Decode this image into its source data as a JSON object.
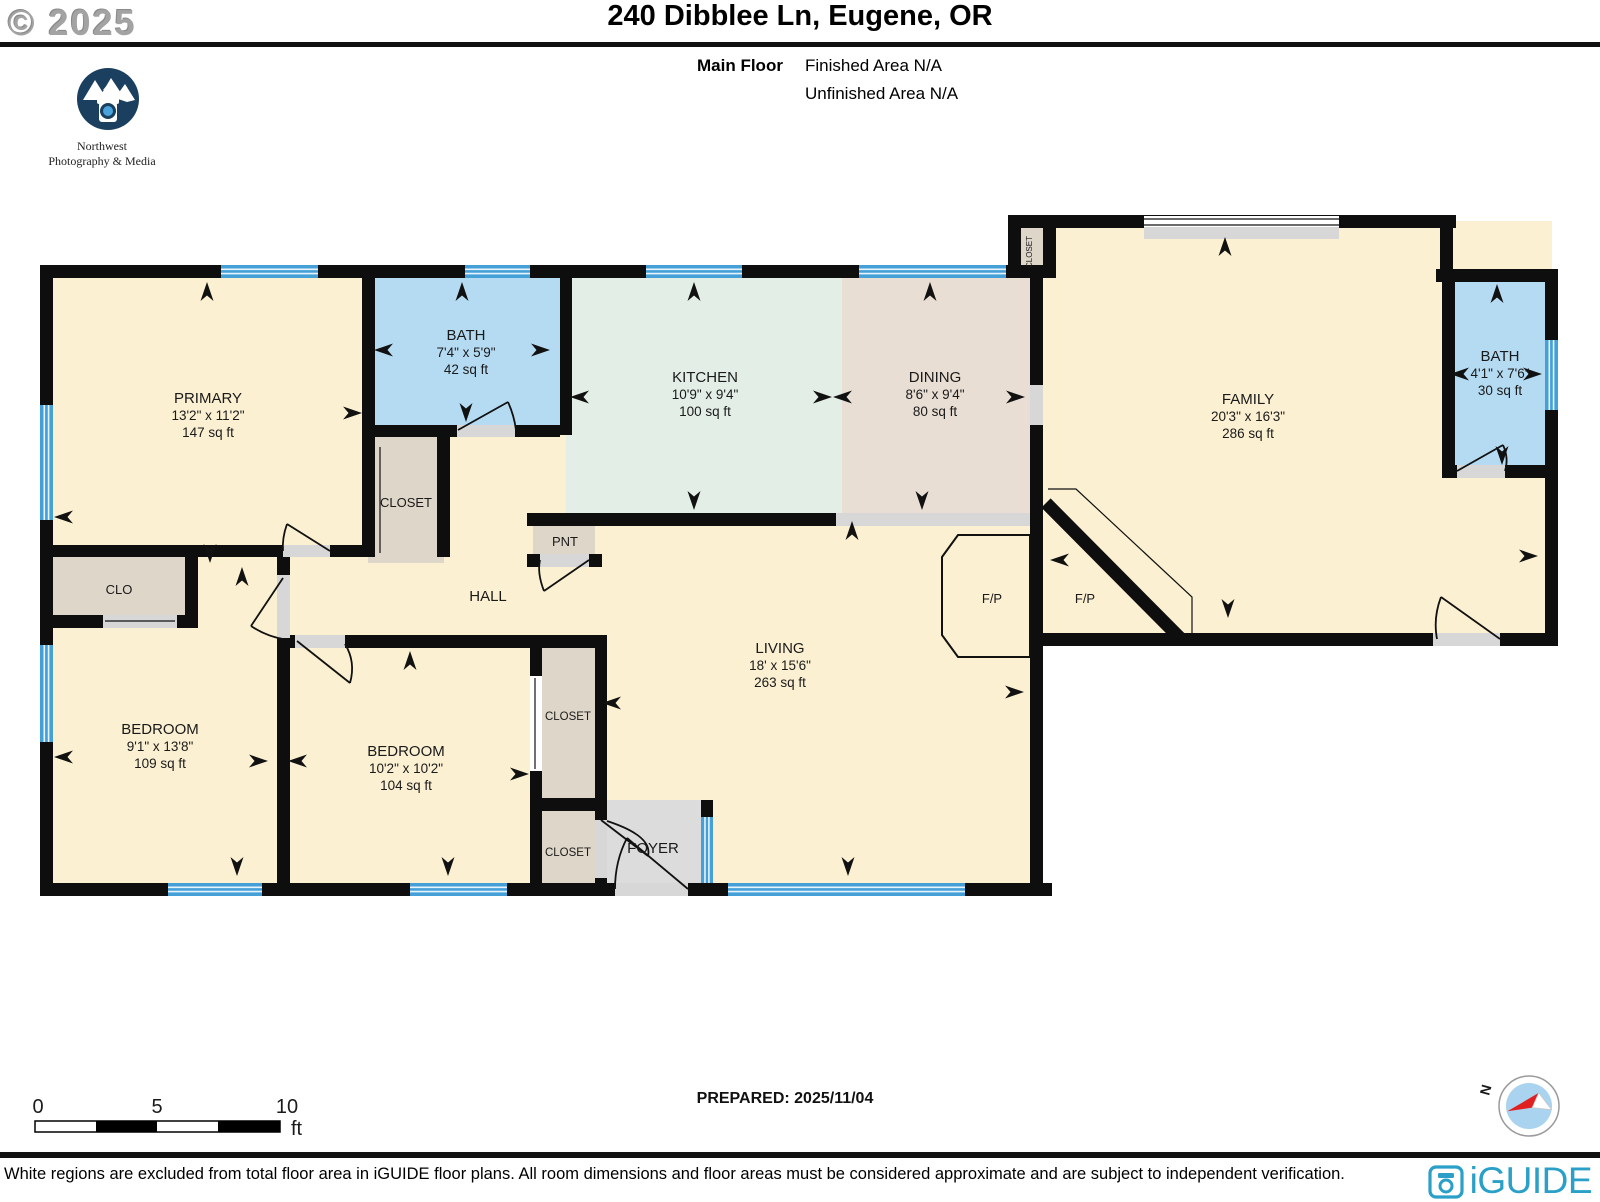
{
  "header": {
    "copyright": "© 2025",
    "title": "240 Dibblee Ln, Eugene, OR",
    "floor_label": "Main Floor",
    "finished_area": "Finished Area N/A",
    "unfinished_area": "Unfinished Area N/A",
    "logo_line1": "Northwest",
    "logo_line2": "Photography & Media"
  },
  "rooms": {
    "primary": {
      "name": "PRIMARY",
      "dims": "13'2\" x 11'2\"",
      "area": "147 sq ft"
    },
    "bath1": {
      "name": "BATH",
      "dims": "7'4\" x 5'9\"",
      "area": "42 sq ft"
    },
    "kitchen": {
      "name": "KITCHEN",
      "dims": "10'9\" x 9'4\"",
      "area": "100 sq ft"
    },
    "dining": {
      "name": "DINING",
      "dims": "8'6\" x 9'4\"",
      "area": "80 sq ft"
    },
    "family": {
      "name": "FAMILY",
      "dims": "20'3\" x 16'3\"",
      "area": "286 sq ft"
    },
    "bath2": {
      "name": "BATH",
      "dims": "4'1\" x 7'6\"",
      "area": "30 sq ft"
    },
    "living": {
      "name": "LIVING",
      "dims": "18' x 15'6\"",
      "area": "263 sq ft"
    },
    "bedroom1": {
      "name": "BEDROOM",
      "dims": "9'1\" x 13'8\"",
      "area": "109 sq ft"
    },
    "bedroom2": {
      "name": "BEDROOM",
      "dims": "10'2\" x 10'2\"",
      "area": "104 sq ft"
    },
    "closet_primary": {
      "label": "CLOSET"
    },
    "closet_top": {
      "label": "CLOSET"
    },
    "closet_a": {
      "label": "CLOSET"
    },
    "closet_b": {
      "label": "CLOSET"
    },
    "clo": {
      "label": "CLO"
    },
    "pantry": {
      "label": "PNT"
    },
    "hall": {
      "label": "HALL"
    },
    "foyer": {
      "label": "FOYER"
    },
    "fp_living": {
      "label": "F/P"
    },
    "fp_family": {
      "label": "F/P"
    }
  },
  "footer": {
    "scale": {
      "t0": "0",
      "t5": "5",
      "t10": "10",
      "unit": "ft"
    },
    "prepared": "PREPARED: 2025/11/04",
    "compass_n": "N",
    "disclaimer": "White regions are excluded from total floor area in iGUIDE floor plans. All room dimensions and floor areas must be considered approximate and are subject to independent verification.",
    "brand": "iGUIDE"
  },
  "colors": {
    "floor_cream": "#fbf0d2",
    "bath_blue": "#b5dbf3",
    "kitchen_green": "#e3eee6",
    "dining_tan": "#e8ded4",
    "closet_tan": "#ded6c9",
    "foyer_gray": "#dcdcdc",
    "window_blue": "#46a0d8",
    "wall_black": "#0e0e0e",
    "brand_teal": "#2a9fc8",
    "compass_red": "#e02020",
    "compass_blue": "#a9d3ee"
  }
}
